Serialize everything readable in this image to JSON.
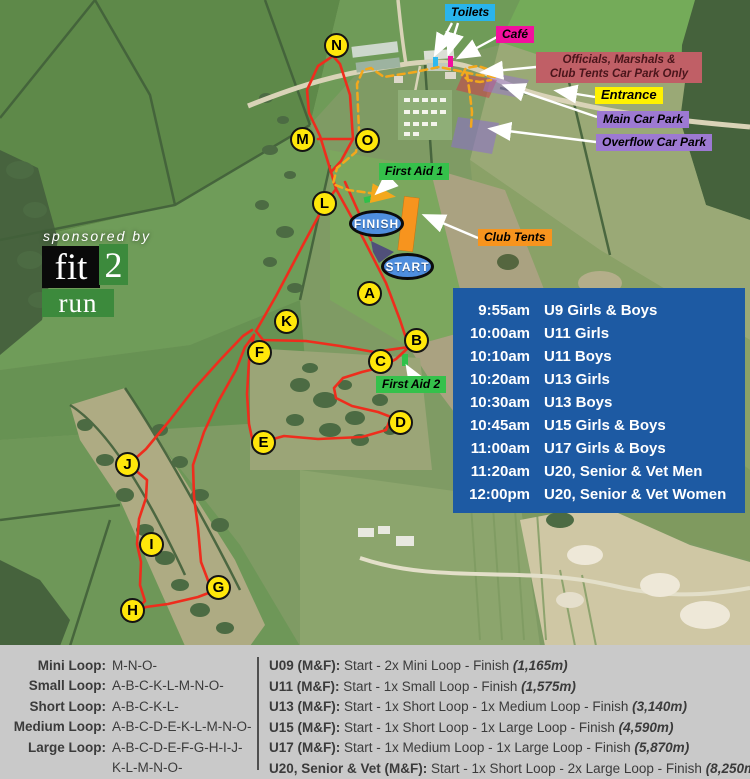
{
  "map": {
    "labels": {
      "toilets": "Toilets",
      "cafe": "Café",
      "officials_line1": "Officials, Marshals &",
      "officials_line2": "Club Tents Car Park Only",
      "entrance": "Entrance",
      "main_car_park": "Main Car Park",
      "overflow_car_park": "Overflow Car Park",
      "first_aid_1": "First Aid 1",
      "first_aid_2": "First Aid 2",
      "club_tents": "Club Tents",
      "finish": "FINISH",
      "start": "START"
    },
    "course_markers": [
      "N",
      "M",
      "O",
      "L",
      "A",
      "K",
      "B",
      "F",
      "C",
      "D",
      "E",
      "J",
      "I",
      "G",
      "H"
    ],
    "colors": {
      "course_line": "#ee2d1d",
      "walk_route": "#f3a81c",
      "schedule_box": "#1d5aa3",
      "marker_fill": "#ffe70a",
      "toilets_label": "#29b4ec",
      "cafe_label": "#f2109e",
      "officials_label": "#c05f66",
      "entrance_label": "#fff200",
      "car_park_label": "#9d79d2",
      "first_aid_label": "#35c14b",
      "club_tents_label": "#f7941e"
    }
  },
  "sponsor": {
    "tagline": "sponsored by",
    "word_top": "fit",
    "digit": "2",
    "word_bottom": "run"
  },
  "schedule": {
    "rows": [
      {
        "time": "9:55am",
        "event": "U9 Girls & Boys"
      },
      {
        "time": "10:00am",
        "event": "U11 Girls"
      },
      {
        "time": "10:10am",
        "event": "U11 Boys"
      },
      {
        "time": "10:20am",
        "event": "U13 Girls"
      },
      {
        "time": "10:30am",
        "event": "U13 Boys"
      },
      {
        "time": "10:45am",
        "event": "U15 Girls & Boys"
      },
      {
        "time": "11:00am",
        "event": "U17 Girls & Boys"
      },
      {
        "time": "11:20am",
        "event": "U20, Senior & Vet Men"
      },
      {
        "time": "12:00pm",
        "event": "U20, Senior & Vet Women"
      }
    ]
  },
  "legend": {
    "loops": [
      {
        "name": "Mini Loop:",
        "sequence": "M-N-O-"
      },
      {
        "name": "Small Loop:",
        "sequence": "A-B-C-K-L-M-N-O-"
      },
      {
        "name": "Short Loop:",
        "sequence": "A-B-C-K-L-"
      },
      {
        "name": "Medium Loop:",
        "sequence": "A-B-C-D-E-K-L-M-N-O-"
      },
      {
        "name": "Large Loop:",
        "sequence": "A-B-C-D-E-F-G-H-I-J-",
        "sequence2": "K-L-M-N-O-"
      }
    ],
    "races": [
      {
        "name": "U09 (M&F):",
        "route": "Start - 2x Mini Loop - Finish ",
        "distance": "(1,165m)"
      },
      {
        "name": "U11 (M&F):",
        "route": "Start - 1x Small Loop - Finish ",
        "distance": "(1,575m)"
      },
      {
        "name": "U13 (M&F):",
        "route": "Start - 1x Short Loop - 1x Medium Loop - Finish ",
        "distance": "(3,140m)"
      },
      {
        "name": "U15 (M&F):",
        "route": "Start - 1x Short Loop - 1x Large Loop - Finish ",
        "distance": "(4,590m)"
      },
      {
        "name": "U17 (M&F):",
        "route": "Start - 1x Medium Loop - 1x Large Loop - Finish ",
        "distance": "(5,870m)"
      },
      {
        "name": "U20, Senior & Vet (M&F):",
        "route": "Start - 1x Short Loop - 2x Large Loop - Finish ",
        "distance": "(8,250m)"
      }
    ]
  }
}
